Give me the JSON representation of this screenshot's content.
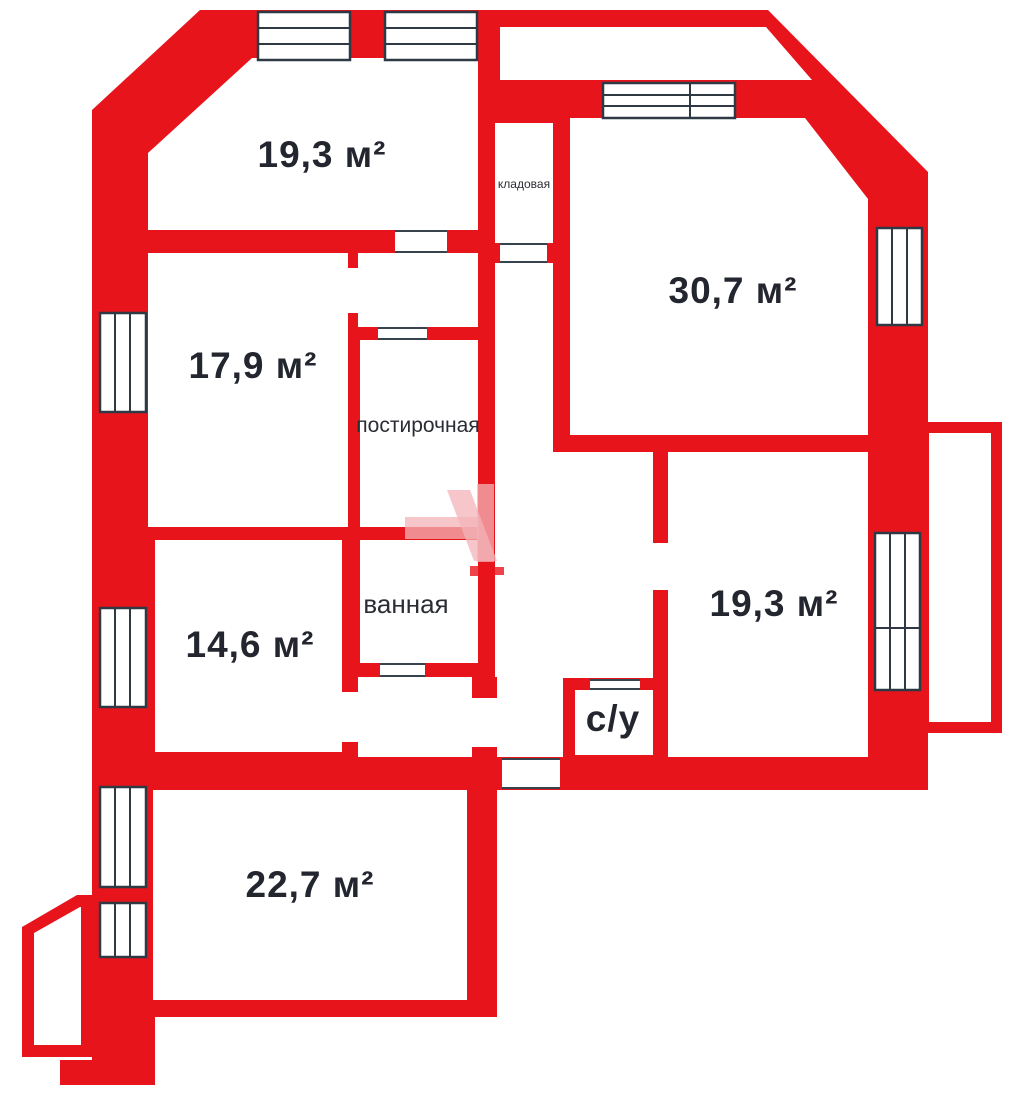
{
  "plan_title": "apartment-floor-plan",
  "rooms": {
    "top_left": "19,3 м²",
    "storage": "кладовая",
    "top_right": "30,7 м²",
    "mid_left": "17,9 м²",
    "laundry": "постирочная",
    "bath": "ванная",
    "lower_left": "14,6 м²",
    "right": "19,3 м²",
    "wc": "с/у",
    "bottom": "22,7 м²"
  },
  "colors": {
    "wall": "#e8141b",
    "frame": "#2e3944",
    "text": "#23262e",
    "watermark": "#f3b3b8"
  }
}
